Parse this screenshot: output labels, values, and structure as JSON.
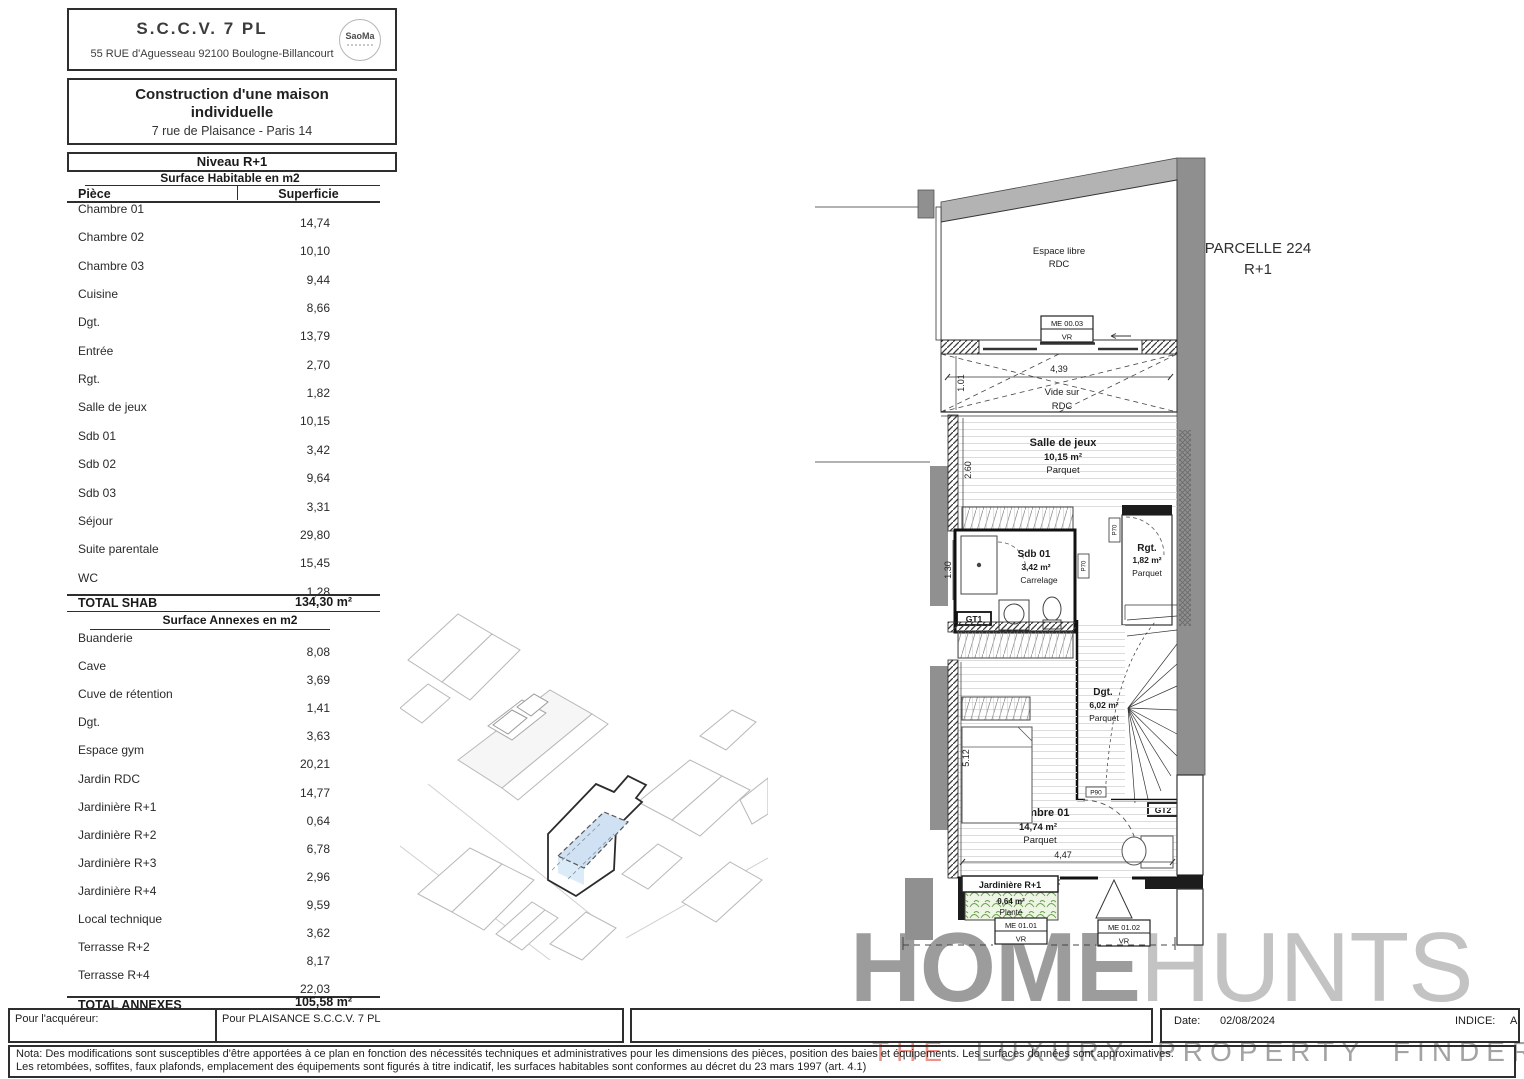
{
  "header": {
    "company": "S.C.C.V. 7 PL",
    "address": "55 RUE d'Aguesseau 92100 Boulogne-Billancourt",
    "logo": "SaoMa",
    "project_line1": "Construction d'une maison",
    "project_line2": "individuelle",
    "project_address": "7 rue de Plaisance - Paris 14"
  },
  "level_title": "Niveau R+1",
  "shab": {
    "title": "Surface Habitable en m2",
    "col_piece": "Pièce",
    "col_superficie": "Superficie",
    "rows": [
      {
        "name": "Chambre 01",
        "value": "14,74"
      },
      {
        "name": "Chambre 02",
        "value": "10,10"
      },
      {
        "name": "Chambre 03",
        "value": "9,44"
      },
      {
        "name": "Cuisine",
        "value": "8,66"
      },
      {
        "name": "Dgt.",
        "value": "13,79"
      },
      {
        "name": "Entrée",
        "value": "2,70"
      },
      {
        "name": "Rgt.",
        "value": "1,82"
      },
      {
        "name": "Salle de jeux",
        "value": "10,15"
      },
      {
        "name": "Sdb 01",
        "value": "3,42"
      },
      {
        "name": "Sdb 02",
        "value": "9,64"
      },
      {
        "name": "Sdb 03",
        "value": "3,31"
      },
      {
        "name": "Séjour",
        "value": "29,80"
      },
      {
        "name": "Suite parentale",
        "value": "15,45"
      },
      {
        "name": "WC",
        "value": "1,28"
      }
    ],
    "total_label": "TOTAL SHAB",
    "total_value": "134,30 m²"
  },
  "annexes": {
    "title": "Surface Annexes en m2",
    "rows": [
      {
        "name": "Buanderie",
        "value": "8,08"
      },
      {
        "name": "Cave",
        "value": "3,69"
      },
      {
        "name": "Cuve de rétention",
        "value": "1,41"
      },
      {
        "name": "Dgt.",
        "value": "3,63"
      },
      {
        "name": "Espace gym",
        "value": "20,21"
      },
      {
        "name": "Jardin RDC",
        "value": "14,77"
      },
      {
        "name": "Jardinière R+1",
        "value": "0,64"
      },
      {
        "name": "Jardinière R+2",
        "value": "6,78"
      },
      {
        "name": "Jardinière R+3",
        "value": "2,96"
      },
      {
        "name": "Jardinière R+4",
        "value": "9,59"
      },
      {
        "name": "Local technique",
        "value": "3,62"
      },
      {
        "name": "Terrasse R+2",
        "value": "8,17"
      },
      {
        "name": "Terrasse R+4",
        "value": "22,03"
      }
    ],
    "total_label": "TOTAL ANNEXES",
    "total_value": "105,58 m²"
  },
  "plan": {
    "parcelle_line1": "PARCELLE 224",
    "parcelle_line2": "R+1",
    "espace_libre_l1": "Espace libre",
    "espace_libre_l2": "RDC",
    "vide_l1": "Vide sur",
    "vide_l2": "RDC",
    "salle_de_jeux": {
      "name": "Salle de jeux",
      "area": "10,15 m²",
      "floor": "Parquet"
    },
    "sdb01": {
      "name": "Sdb 01",
      "area": "3,42 m²",
      "floor": "Carrelage"
    },
    "rgt": {
      "name": "Rgt.",
      "area": "1,82 m²",
      "floor": "Parquet"
    },
    "dgt": {
      "name": "Dgt.",
      "area": "6,02 m²",
      "floor": "Parquet"
    },
    "chambre01": {
      "name": "Chambre 01",
      "area": "14,74 m²",
      "floor": "Parquet"
    },
    "jardiniere": {
      "name": "Jardinière R+1",
      "area": "0,64 m²",
      "floor": "Planté"
    },
    "dims": {
      "d439": "4,39",
      "d101": "1.01",
      "d260": "2.60",
      "d130": "1.30",
      "d512": "5.12",
      "d447": "4,47"
    },
    "tags": {
      "me0003": "ME 00.03",
      "vr1": "VR",
      "me0101": "ME 01.01",
      "vr2": "VR",
      "me0102": "ME 01.02",
      "vr3": "VR",
      "gt1": "GT1",
      "gt2": "GT2",
      "p70a": "P70",
      "p70b": "P70",
      "p90": "P90"
    }
  },
  "watermark": {
    "home": "HOME",
    "hunts": "HUNTS",
    "the": "THE",
    "rest": "LUXURY PROPERTY FINDERS"
  },
  "signoff": {
    "acquereur": "Pour l'acquéreur:",
    "plaisance": "Pour PLAISANCE S.C.C.V. 7 PL",
    "date_label": "Date:",
    "date_value": "02/08/2024",
    "indice_label": "INDICE:",
    "indice_value": "A"
  },
  "nota": {
    "line1": "Nota: Des modifications sont susceptibles d'être apportées à ce plan en fonction des nécessités techniques et administratives pour les dimensions des pièces, position des baies et équipements. Les surfaces données sont approximatives.",
    "line2": "Les retombées, soffites, faux plafonds, emplacement des équipements sont figurés à titre indicatif, les surfaces habitables sont conformes au décret du 23 mars 1997 (art. 4.1)"
  }
}
